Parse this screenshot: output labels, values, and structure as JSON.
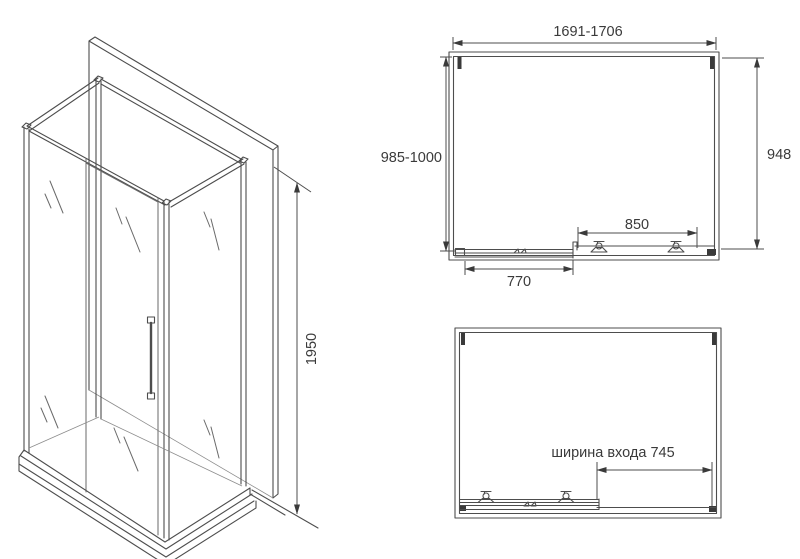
{
  "colors": {
    "background": "#ffffff",
    "line": "#4d4d4d",
    "line_light": "#8c8c8c",
    "text": "#3a3a3a"
  },
  "iso_view": {
    "height_label": "1950"
  },
  "plan_closed": {
    "width_label": "1691-1706",
    "depth_left_label": "985-1000",
    "depth_right_label": "948",
    "track_label": "850",
    "door_label": "770"
  },
  "plan_open": {
    "entrance_label": "ширина входа 745"
  }
}
